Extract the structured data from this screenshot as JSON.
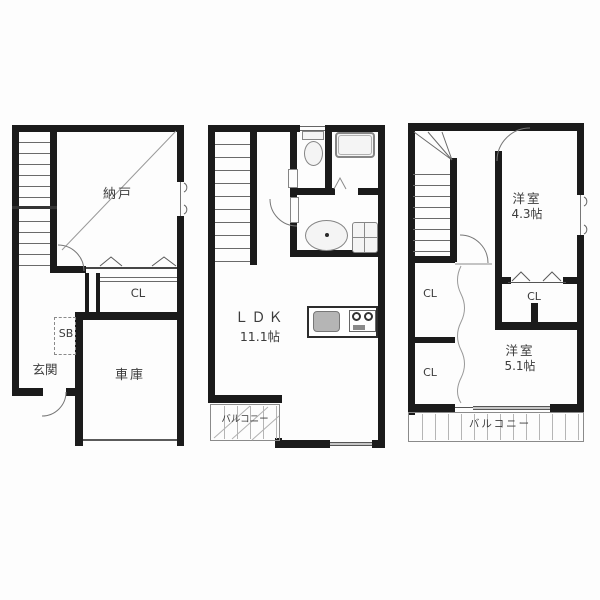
{
  "floorplan": {
    "floors": [
      {
        "name": "left-floor",
        "labels": {
          "storage": "納戸",
          "closet": "CL",
          "shoebox": "SB",
          "entrance": "玄関",
          "garage": "車庫"
        }
      },
      {
        "name": "middle-floor",
        "labels": {
          "ldk": "ＬＤＫ",
          "ldk_size": "11.1帖",
          "balcony": "バルコニー"
        }
      },
      {
        "name": "right-floor",
        "labels": {
          "room_upper": "洋室",
          "room_upper_size": "4.3帖",
          "closet_hall_upper": "CL",
          "closet_hall_lower": "CL",
          "closet_room": "CL",
          "room_lower": "洋室",
          "room_lower_size": "5.1帖",
          "balcony": "バルコニー"
        }
      }
    ]
  }
}
